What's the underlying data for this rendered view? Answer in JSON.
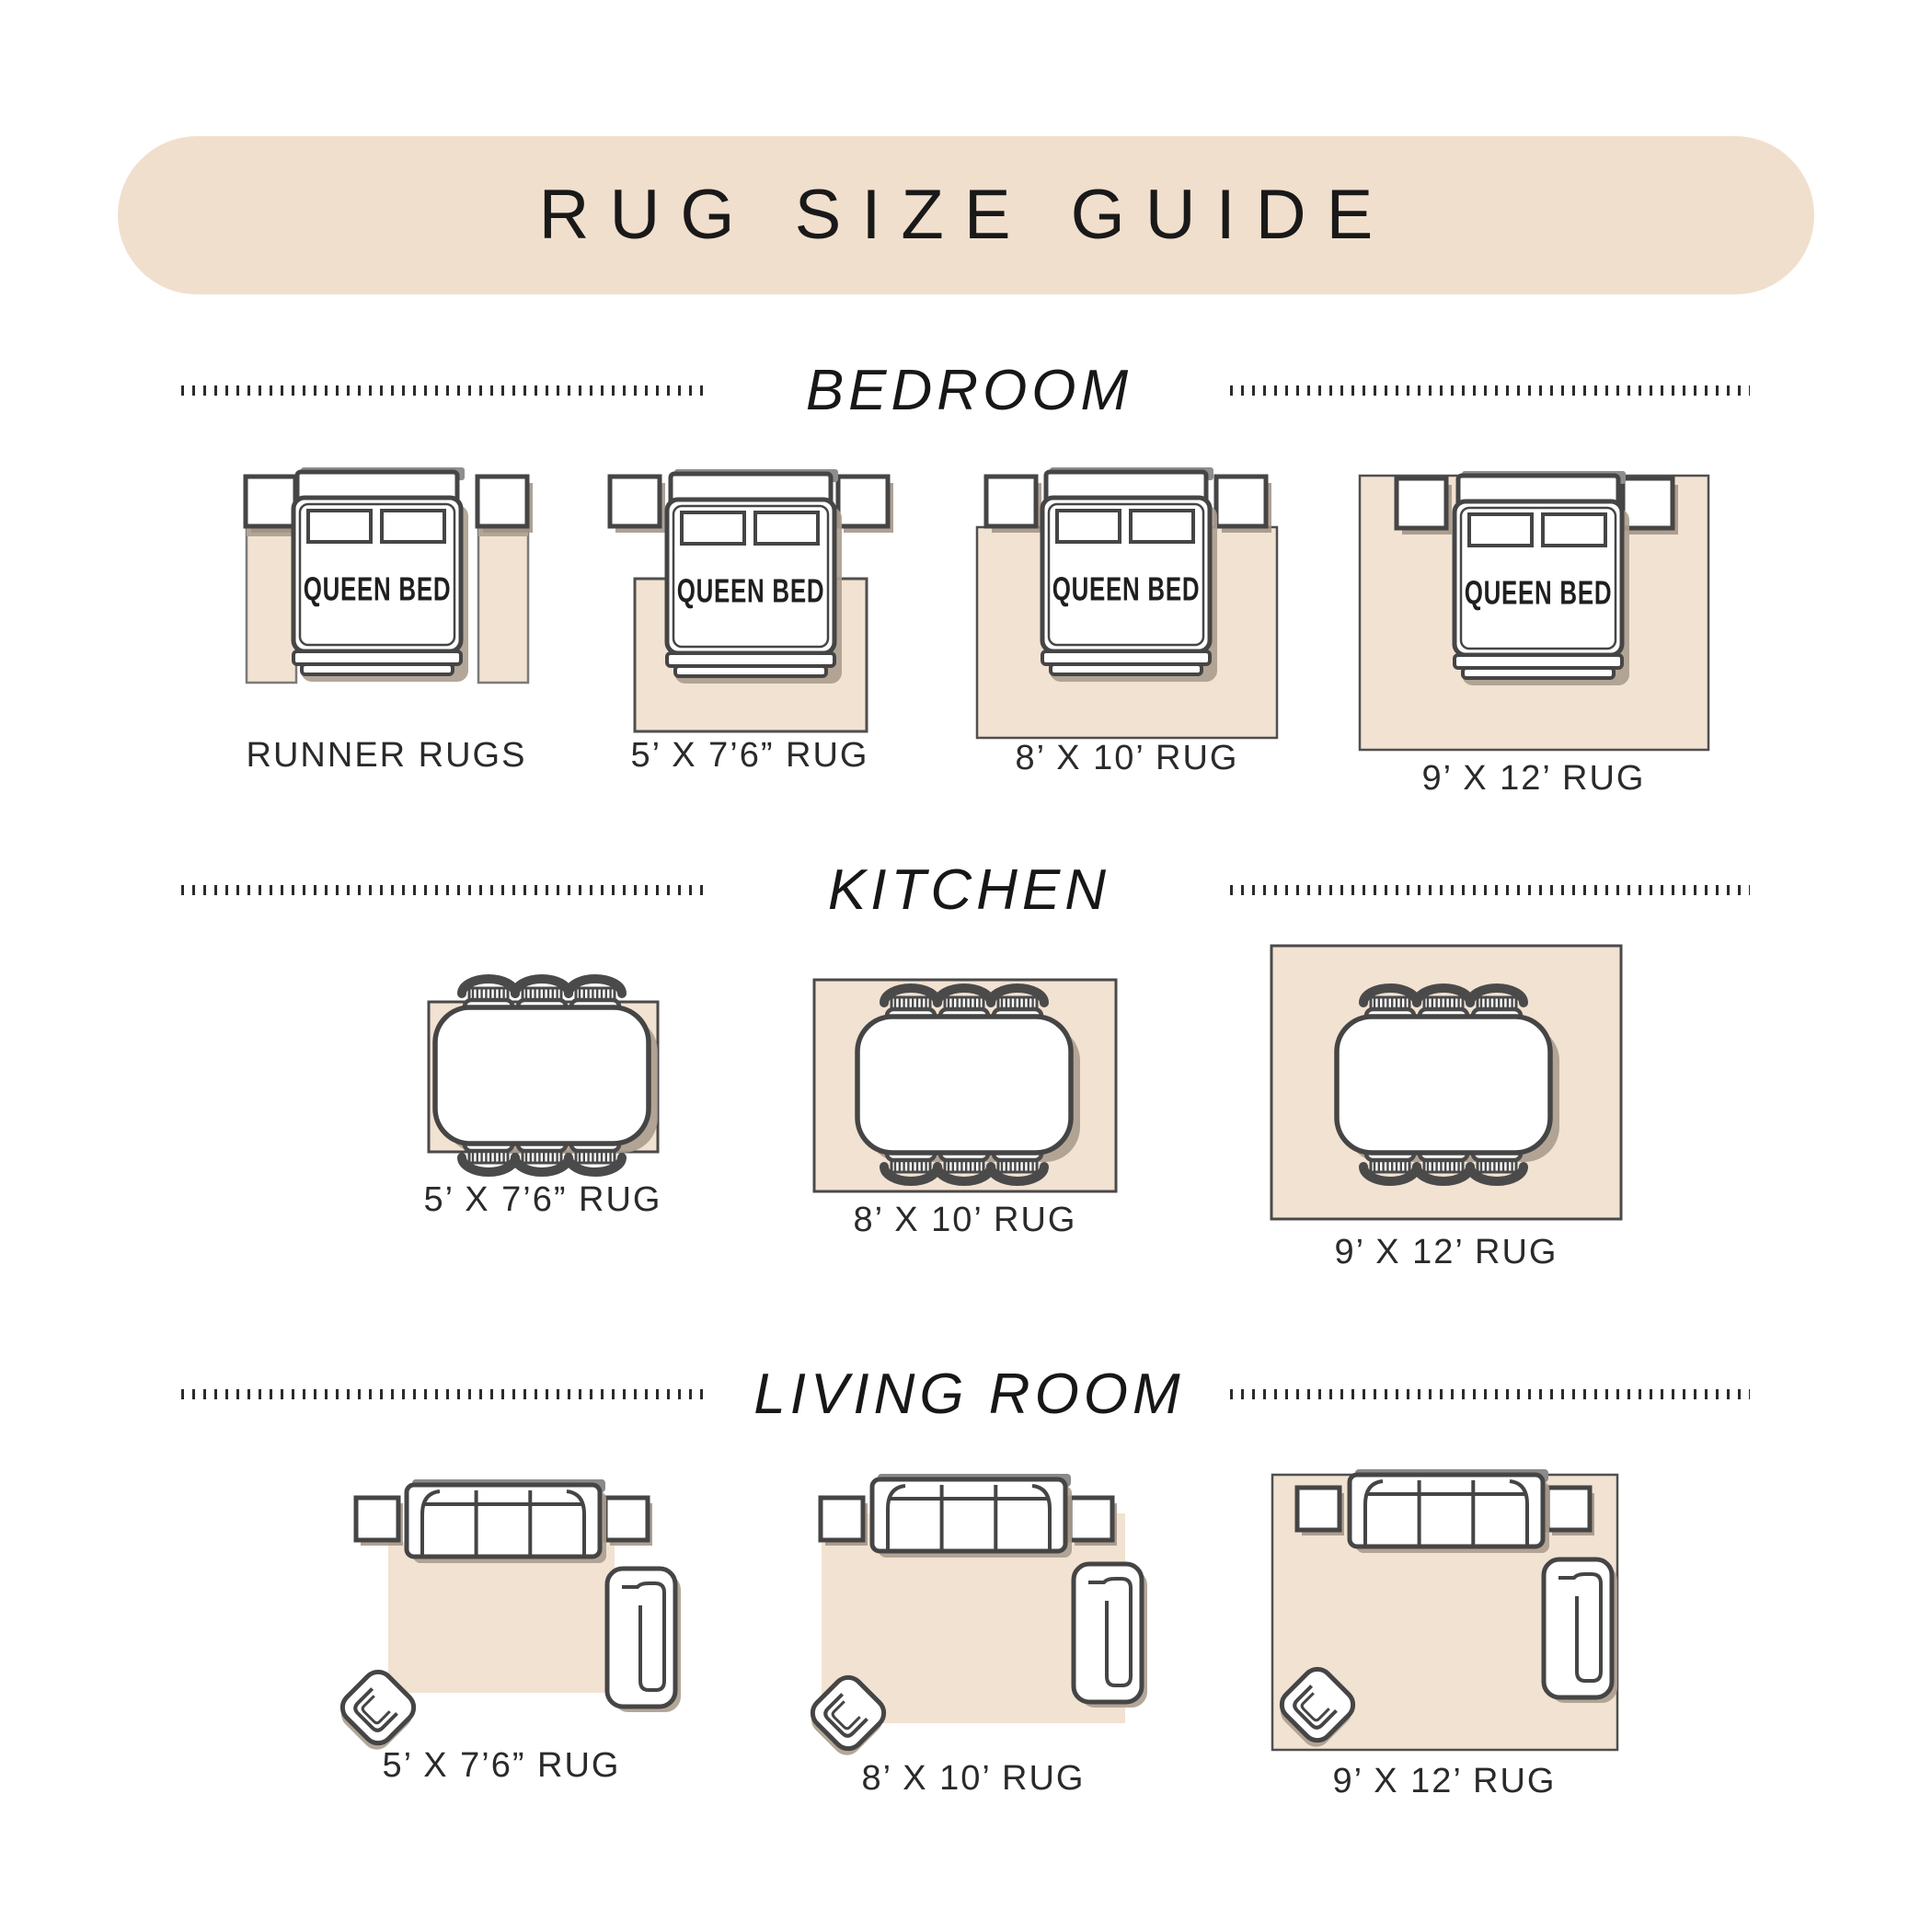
{
  "title": "RUG SIZE GUIDE",
  "labels": {
    "queen_bed": "QUEEN BED"
  },
  "colors": {
    "banner_beige": "#f1dfcd",
    "rug_beige": "#f2e2d2",
    "shadow_taupe": "#ab9d8e",
    "outline_gray": "#454545",
    "text_black": "#191919"
  },
  "sections": [
    {
      "name": "BEDROOM",
      "figures": [
        {
          "caption": "RUNNER RUGS",
          "illustration": "queen-bed-with-two-runner-rugs"
        },
        {
          "caption": "5’ X 7’6” RUG",
          "illustration": "queen-bed-on-5x7-rug"
        },
        {
          "caption": "8’ X 10’ RUG",
          "illustration": "queen-bed-on-8x10-rug"
        },
        {
          "caption": "9’ X 12’ RUG",
          "illustration": "queen-bed-on-9x12-rug"
        }
      ]
    },
    {
      "name": "KITCHEN",
      "figures": [
        {
          "caption": "5’ X 7’6” RUG",
          "illustration": "dining-table-on-5x7-rug"
        },
        {
          "caption": "8’ X 10’ RUG",
          "illustration": "dining-table-on-8x10-rug"
        },
        {
          "caption": "9’ X 12’ RUG",
          "illustration": "dining-table-on-9x12-rug"
        }
      ]
    },
    {
      "name": "LIVING ROOM",
      "figures": [
        {
          "caption": "5’ X 7’6” RUG",
          "illustration": "sofa-set-on-5x7-rug"
        },
        {
          "caption": "8’ X 10’ RUG",
          "illustration": "sofa-set-on-8x10-rug"
        },
        {
          "caption": "9’ X 12’ RUG",
          "illustration": "sofa-set-on-9x12-rug"
        }
      ]
    }
  ]
}
